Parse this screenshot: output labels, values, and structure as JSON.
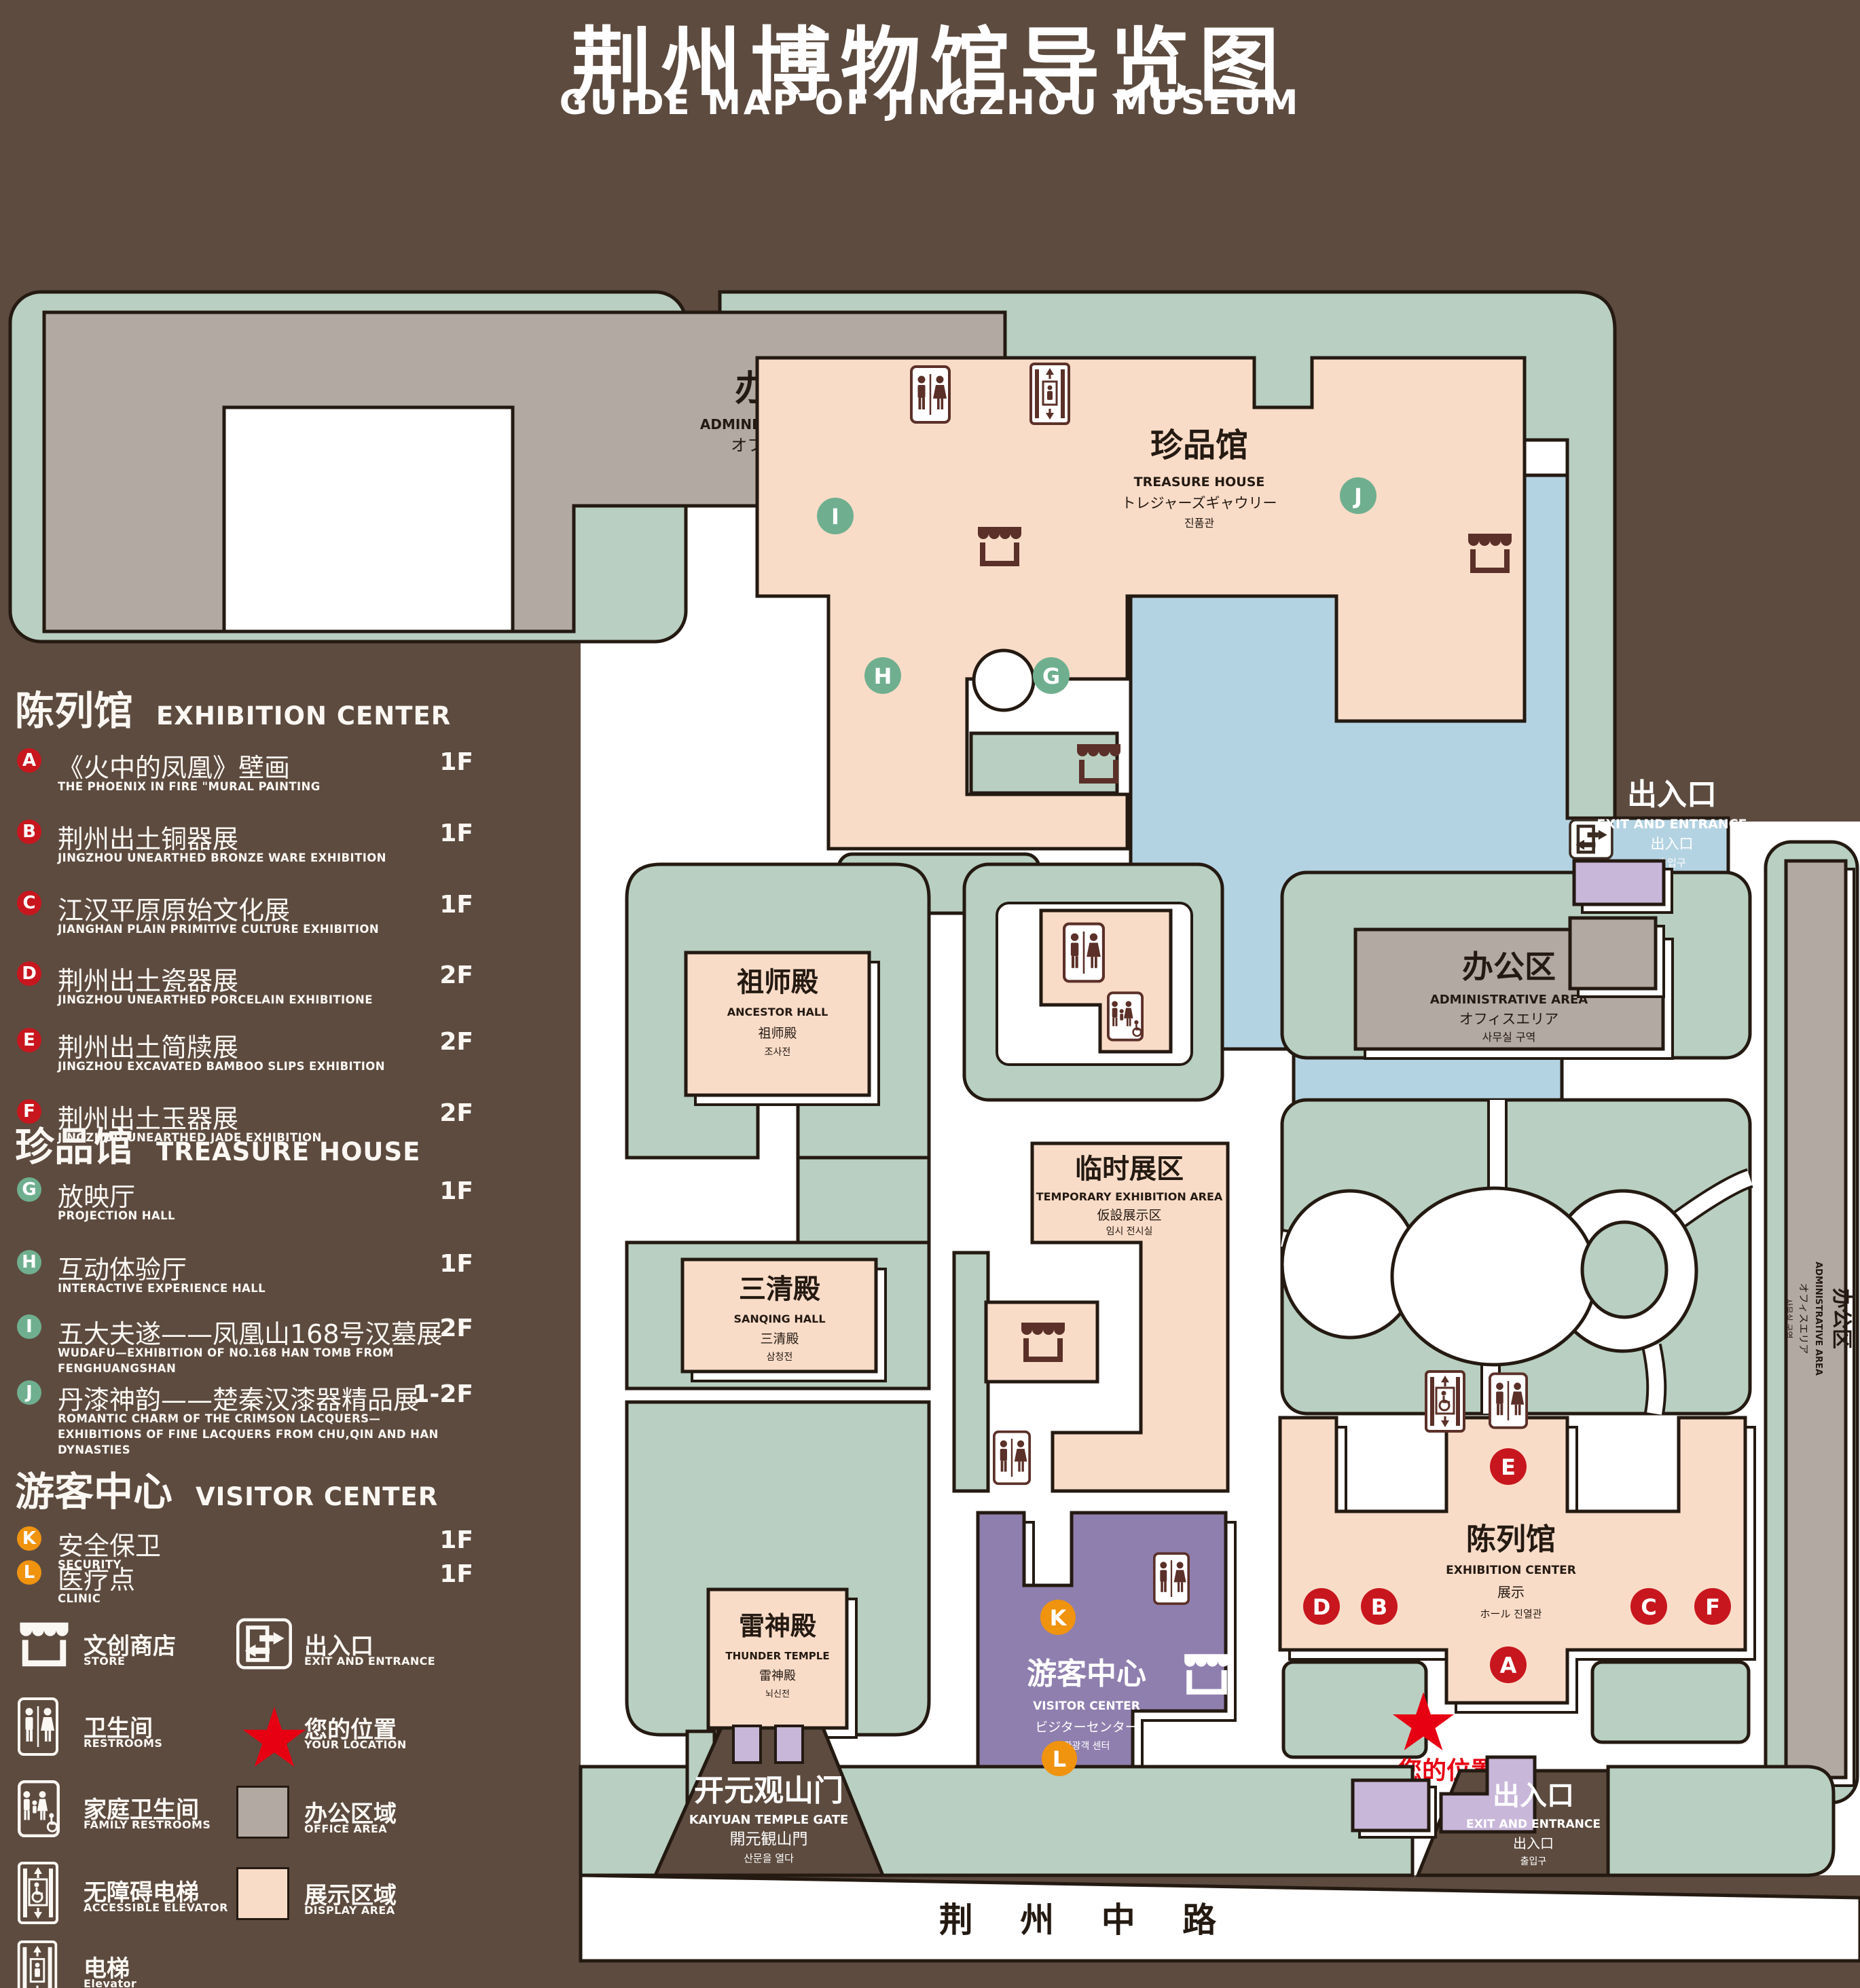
{
  "title": {
    "zh": "荆州博物馆导览图",
    "en": "GUIDE MAP OF JINGZHOU MUSEUM"
  },
  "colors": {
    "background_brown": "#5d4b3f",
    "park_green": "#b8cfc1",
    "display_pink": "#f9dcc8",
    "office_gray": "#b3a9a3",
    "lake_blue": "#b4d3e2",
    "visitor_purple": "#8f7fae",
    "gate_lilac": "#c8b7d9",
    "marker_red": "#c8161e",
    "marker_green": "#6faf8f",
    "marker_orange": "#f0930f",
    "star_red": "#e60012",
    "icon_brown": "#5b3028",
    "outline_dark": "#241a12",
    "walkway_white": "#ffffff"
  },
  "legend": {
    "sections": [
      {
        "id": "exhibition_center",
        "zh": "陈列馆",
        "en": "EXHIBITION CENTER",
        "marker_color": "#c8161e",
        "items": [
          {
            "letter": "A",
            "zh": "《火中的凤凰》壁画",
            "en": "THE PHOENIX IN FIRE \"MURAL PAINTING",
            "floor": "1F"
          },
          {
            "letter": "B",
            "zh": "荆州出土铜器展",
            "en": "JINGZHOU UNEARTHED BRONZE WARE EXHIBITION",
            "floor": "1F"
          },
          {
            "letter": "C",
            "zh": "江汉平原原始文化展",
            "en": "JIANGHAN PLAIN PRIMITIVE CULTURE EXHIBITION",
            "floor": "1F"
          },
          {
            "letter": "D",
            "zh": "荆州出土瓷器展",
            "en": "JINGZHOU UNEARTHED PORCELAIN EXHIBITIONE",
            "floor": "2F"
          },
          {
            "letter": "E",
            "zh": "荆州出土简牍展",
            "en": "JINGZHOU EXCAVATED BAMBOO SLIPS EXHIBITION",
            "floor": "2F"
          },
          {
            "letter": "F",
            "zh": "荆州出土玉器展",
            "en": "JINGZHOU UNEARTHED JADE EXHIBITION",
            "floor": "2F"
          }
        ]
      },
      {
        "id": "treasure_house",
        "zh": "珍品馆",
        "en": "TREASURE HOUSE",
        "marker_color": "#6faf8f",
        "items": [
          {
            "letter": "G",
            "zh": "放映厅",
            "en": "PROJECTION HALL",
            "floor": "1F"
          },
          {
            "letter": "H",
            "zh": "互动体验厅",
            "en": "INTERACTIVE EXPERIENCE HALL",
            "floor": "1F"
          },
          {
            "letter": "I",
            "zh": "五大夫遂——凤凰山168号汉墓展",
            "en": "WUDAFU—EXHIBITION OF NO.168 HAN TOMB FROM FENGHUANGSHAN",
            "floor": "2F"
          },
          {
            "letter": "J",
            "zh": "丹漆神韵——楚秦汉漆器精品展",
            "en": "ROMANTIC CHARM OF THE CRIMSON LACQUERS—EXHIBITIONS OF FINE LACQUERS FROM CHU,QIN AND HAN DYNASTIES",
            "floor": "1-2F"
          }
        ]
      },
      {
        "id": "visitor_center",
        "zh": "游客中心",
        "en": "VISITOR CENTER",
        "marker_color": "#f0930f",
        "items": [
          {
            "letter": "K",
            "zh": "安全保卫",
            "en": "SECURITY",
            "floor": "1F"
          },
          {
            "letter": "L",
            "zh": "医疗点",
            "en": "CLINIC",
            "floor": "1F"
          }
        ]
      }
    ],
    "symbols": [
      {
        "icon": "store-icon",
        "zh": "文创商店",
        "en": "STORE"
      },
      {
        "icon": "exit-icon",
        "zh": "出入口",
        "en": "EXIT AND ENTRANCE"
      },
      {
        "icon": "restrooms-icon",
        "zh": "卫生间",
        "en": "RESTROOMS"
      },
      {
        "icon": "location-star-icon",
        "zh": "您的位置",
        "en": "YOUR LOCATION"
      },
      {
        "icon": "family-restrooms-icon",
        "zh": "家庭卫生间",
        "en": "FAMILY RESTROOMS"
      },
      {
        "icon": "office-area-swatch",
        "zh": "办公区域",
        "en": "OFFICE AREA"
      },
      {
        "icon": "accessible-elevator-icon",
        "zh": "无障碍电梯",
        "en": "ACCESSIBLE ELEVATOR"
      },
      {
        "icon": "display-area-swatch",
        "zh": "展示区域",
        "en": "DISPLAY AREA"
      },
      {
        "icon": "elevator-icon",
        "zh": "电梯",
        "en": "Elevator"
      }
    ]
  },
  "map": {
    "admin_nw": {
      "zh": "办公区",
      "en": "ADMINISTRATIVE AREA",
      "jp": "オフィスエリア",
      "kr": "사무실 구역"
    },
    "admin_center": {
      "zh": "办公区",
      "en": "ADMINISTRATIVE AREA",
      "jp": "オフィスエリア",
      "kr": "사무실 구역"
    },
    "admin_east": {
      "zh": "办公区",
      "en": "ADMINISTRATIVE AREA",
      "jp": "オフィスエリア",
      "kr": "사무실 구역"
    },
    "treasure_house": {
      "zh": "珍品馆",
      "en": "TREASURE HOUSE",
      "jp": "トレジャーズギャウリー",
      "kr": "진품관"
    },
    "ancestor_hall": {
      "zh": "祖师殿",
      "en": "ANCESTOR HALL",
      "jp": "祖师殿",
      "kr": "조사전"
    },
    "sanqing_hall": {
      "zh": "三清殿",
      "en": "SANQING HALL",
      "jp": "三清殿",
      "kr": "삼청전"
    },
    "thunder_temple": {
      "zh": "雷神殿",
      "en": "THUNDER TEMPLE",
      "jp": "雷神殿",
      "kr": "뇌신전"
    },
    "temporary_exhibition": {
      "zh": "临时展区",
      "en": "TEMPORARY EXHIBITION AREA",
      "jp": "仮設展示区",
      "kr": "임시 전시실"
    },
    "exhibition_center": {
      "zh": "陈列馆",
      "en": "EXHIBITION CENTER",
      "jp": "展示",
      "jp_kr": "ホール 진열관"
    },
    "visitor_center": {
      "zh": "游客中心",
      "en": "VISITOR CENTER",
      "jp": "ビジターセンター",
      "kr": "관광객 센터"
    },
    "kaiyuan_gate": {
      "zh": "开元观山门",
      "en": "KAIYUAN TEMPLE GATE",
      "jp": "開元観山門",
      "kr": "산문을 열다"
    },
    "exit_ne": {
      "zh": "出入口",
      "en": "EXIT AND ENTRANCE",
      "jp": "出入口",
      "kr": "출입구"
    },
    "exit_se": {
      "zh": "出入口",
      "en": "EXIT AND ENTRANCE",
      "jp": "出入口",
      "kr": "출입구"
    },
    "road": {
      "zh": "荆 州 中 路"
    },
    "your_location": {
      "zh": "您的位置"
    }
  }
}
